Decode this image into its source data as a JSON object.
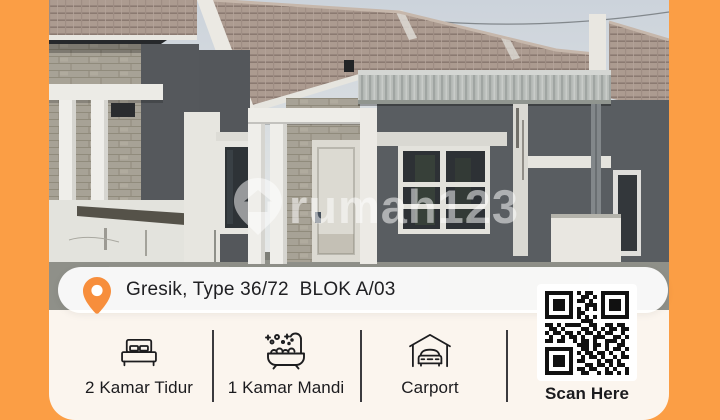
{
  "frame": {
    "background": "#FB9E45"
  },
  "photo": {
    "watermark_text": "rumah123"
  },
  "card": {
    "location_text": "Gresik, Type 36/72  BLOK A/03",
    "features": [
      {
        "icon": "bed-icon",
        "label": "2 Kamar Tidur"
      },
      {
        "icon": "bathtub-icon",
        "label": "1 Kamar Mandi"
      },
      {
        "icon": "carport-icon",
        "label": "Carport"
      },
      {
        "icon": "qr-code",
        "label": "Scan Here"
      }
    ],
    "qr_matrix": [
      "111111101011001111111",
      "100000100110101000001",
      "101110101101001011101",
      "101110100011101011101",
      "101110101010101011101",
      "100000101100001000001",
      "111111101010101111111",
      "000000000111000000000",
      "110101111001100110110",
      "011010000110101011011",
      "101101101011010110010",
      "010010110100111001101",
      "110110010110100111010",
      "000000001110110100110",
      "111111100110100101101",
      "100000101011011010010",
      "101110100101101001011",
      "101110101100010110100",
      "101110100011011010110",
      "100000101101100101001",
      "111111100110010110101"
    ]
  },
  "colors": {
    "frame_orange": "#FB9E45",
    "pin_orange": "#F78E3C",
    "card_cream": "#FBF5EE",
    "text_dark": "#1C1C1E"
  }
}
